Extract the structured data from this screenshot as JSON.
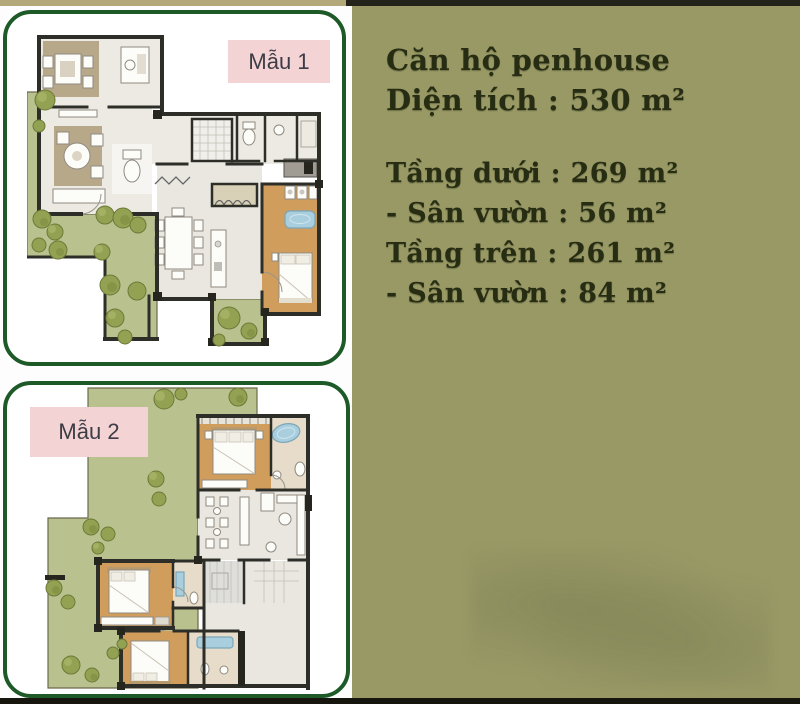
{
  "page": {
    "background_left": "#fdfdfd",
    "background_right": "#999966",
    "card_border_color": "#1d5a28",
    "label_background": "#f3d3d3",
    "top_strip_left_color": "#b2a87a",
    "top_strip_right_color": "#23231a",
    "bottom_bar_color": "#16160f"
  },
  "cards": [
    {
      "label": "Mẫu 1"
    },
    {
      "label": "Mẫu 2"
    }
  ],
  "info_panel": {
    "title": "Căn hộ penhouse",
    "area_line": "Diện tích : 530 m²",
    "spec_lines": [
      "Tầng dưới : 269 m²",
      "- Sân vườn : 56 m²",
      "Tầng trên : 261 m²",
      "- Sân vườn : 84 m²"
    ],
    "text_color": "#262d12"
  },
  "floorplan_legend": {
    "wall_color": "#2e2e28",
    "floor_color": "#eceae3",
    "wood_floor_color": "#d19d5c",
    "garden_color": "#b9c28f",
    "tree_color": "#93a152",
    "bath_fixture_color": "#a9cede"
  }
}
